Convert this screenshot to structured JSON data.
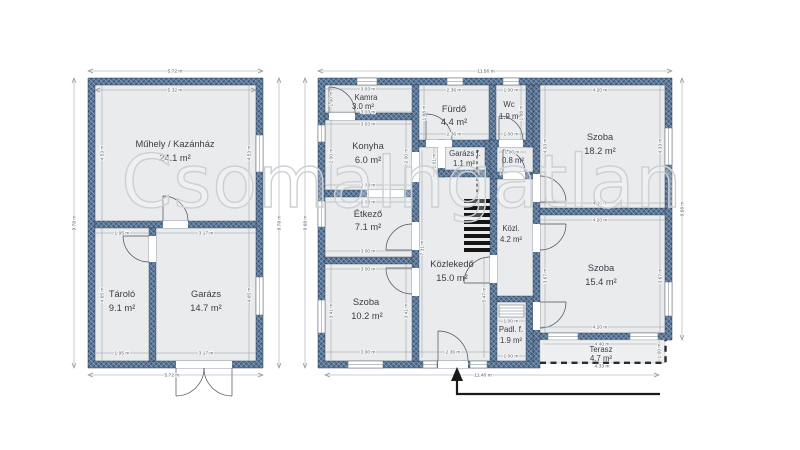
{
  "watermark": "CsomaIngatlan",
  "colors": {
    "wall_base": "#5e7a9b",
    "wall_dark": "#36506e",
    "wall_light": "#8da3bc",
    "room_fill": "#e9ebed",
    "dim_color": "#54585d",
    "label_color": "#393e44",
    "watermark_stroke": "#ccd0d4",
    "stairs_color": "#151515",
    "arrow_color": "#1a1a1a"
  },
  "left_building": {
    "rooms": {
      "muhely": {
        "name": "Műhely / Kazánház",
        "area": "24.1 m²"
      },
      "tarolo": {
        "name": "Tároló",
        "area": "9.1 m²"
      },
      "garazs": {
        "name": "Garázs",
        "area": "14.7 m²"
      }
    }
  },
  "right_building": {
    "rooms": {
      "kamra": {
        "name": "Kamra",
        "area": "3.0 m²"
      },
      "konyha": {
        "name": "Konyha",
        "area": "6.0 m²"
      },
      "furdo": {
        "name": "Fürdő",
        "area": "4.4 m²"
      },
      "wc": {
        "name": "Wc",
        "area": "1.9 m²"
      },
      "szoba_nagy": {
        "name": "Szoba",
        "area": "18.2 m²"
      },
      "etkezo": {
        "name": "Étkező",
        "area": "7.1 m²"
      },
      "garazs_f": {
        "name": "Garázs f.",
        "area": "1.1 m²"
      },
      "eloter": {
        "area": "0.8 m²"
      },
      "kozl": {
        "name": "Közl.",
        "area": "4.2 m²"
      },
      "kozlekedo": {
        "name": "Közlekedő",
        "area": "15.0 m²"
      },
      "szoba_kozep": {
        "name": "Szoba",
        "area": "15.4 m²"
      },
      "szoba_kis": {
        "name": "Szoba",
        "area": "10.2 m²"
      },
      "padlas_feljaro": {
        "name": "Padl. f.",
        "area": "1.9 m²"
      },
      "terasz": {
        "name": "Terasz",
        "area": "4.7 m²"
      }
    }
  },
  "dimensions": {
    "d572": "5.72 m",
    "d532": "5.32 m",
    "d978": "9.78 m",
    "d453": "4.53 m",
    "d465": "4.65 m",
    "d195": "1.95 m",
    "d317": "3.17 m",
    "d1156": "11.56 m",
    "d1146": "11.46 m",
    "d968": "9.68 m",
    "d303": "3.03 m",
    "d100": "1.00 m",
    "d200": "2.00 m",
    "d236": "2.36 m",
    "d188": "1.88 m",
    "d420": "4.20 m",
    "d433": "4.33 m",
    "d300": "3.00 m",
    "d341": "3.41 m",
    "d731": "7.31 m",
    "d547": "5.47 m",
    "d367": "3.67 m",
    "d440": "4.40 m",
    "d101": "1.01 m"
  }
}
